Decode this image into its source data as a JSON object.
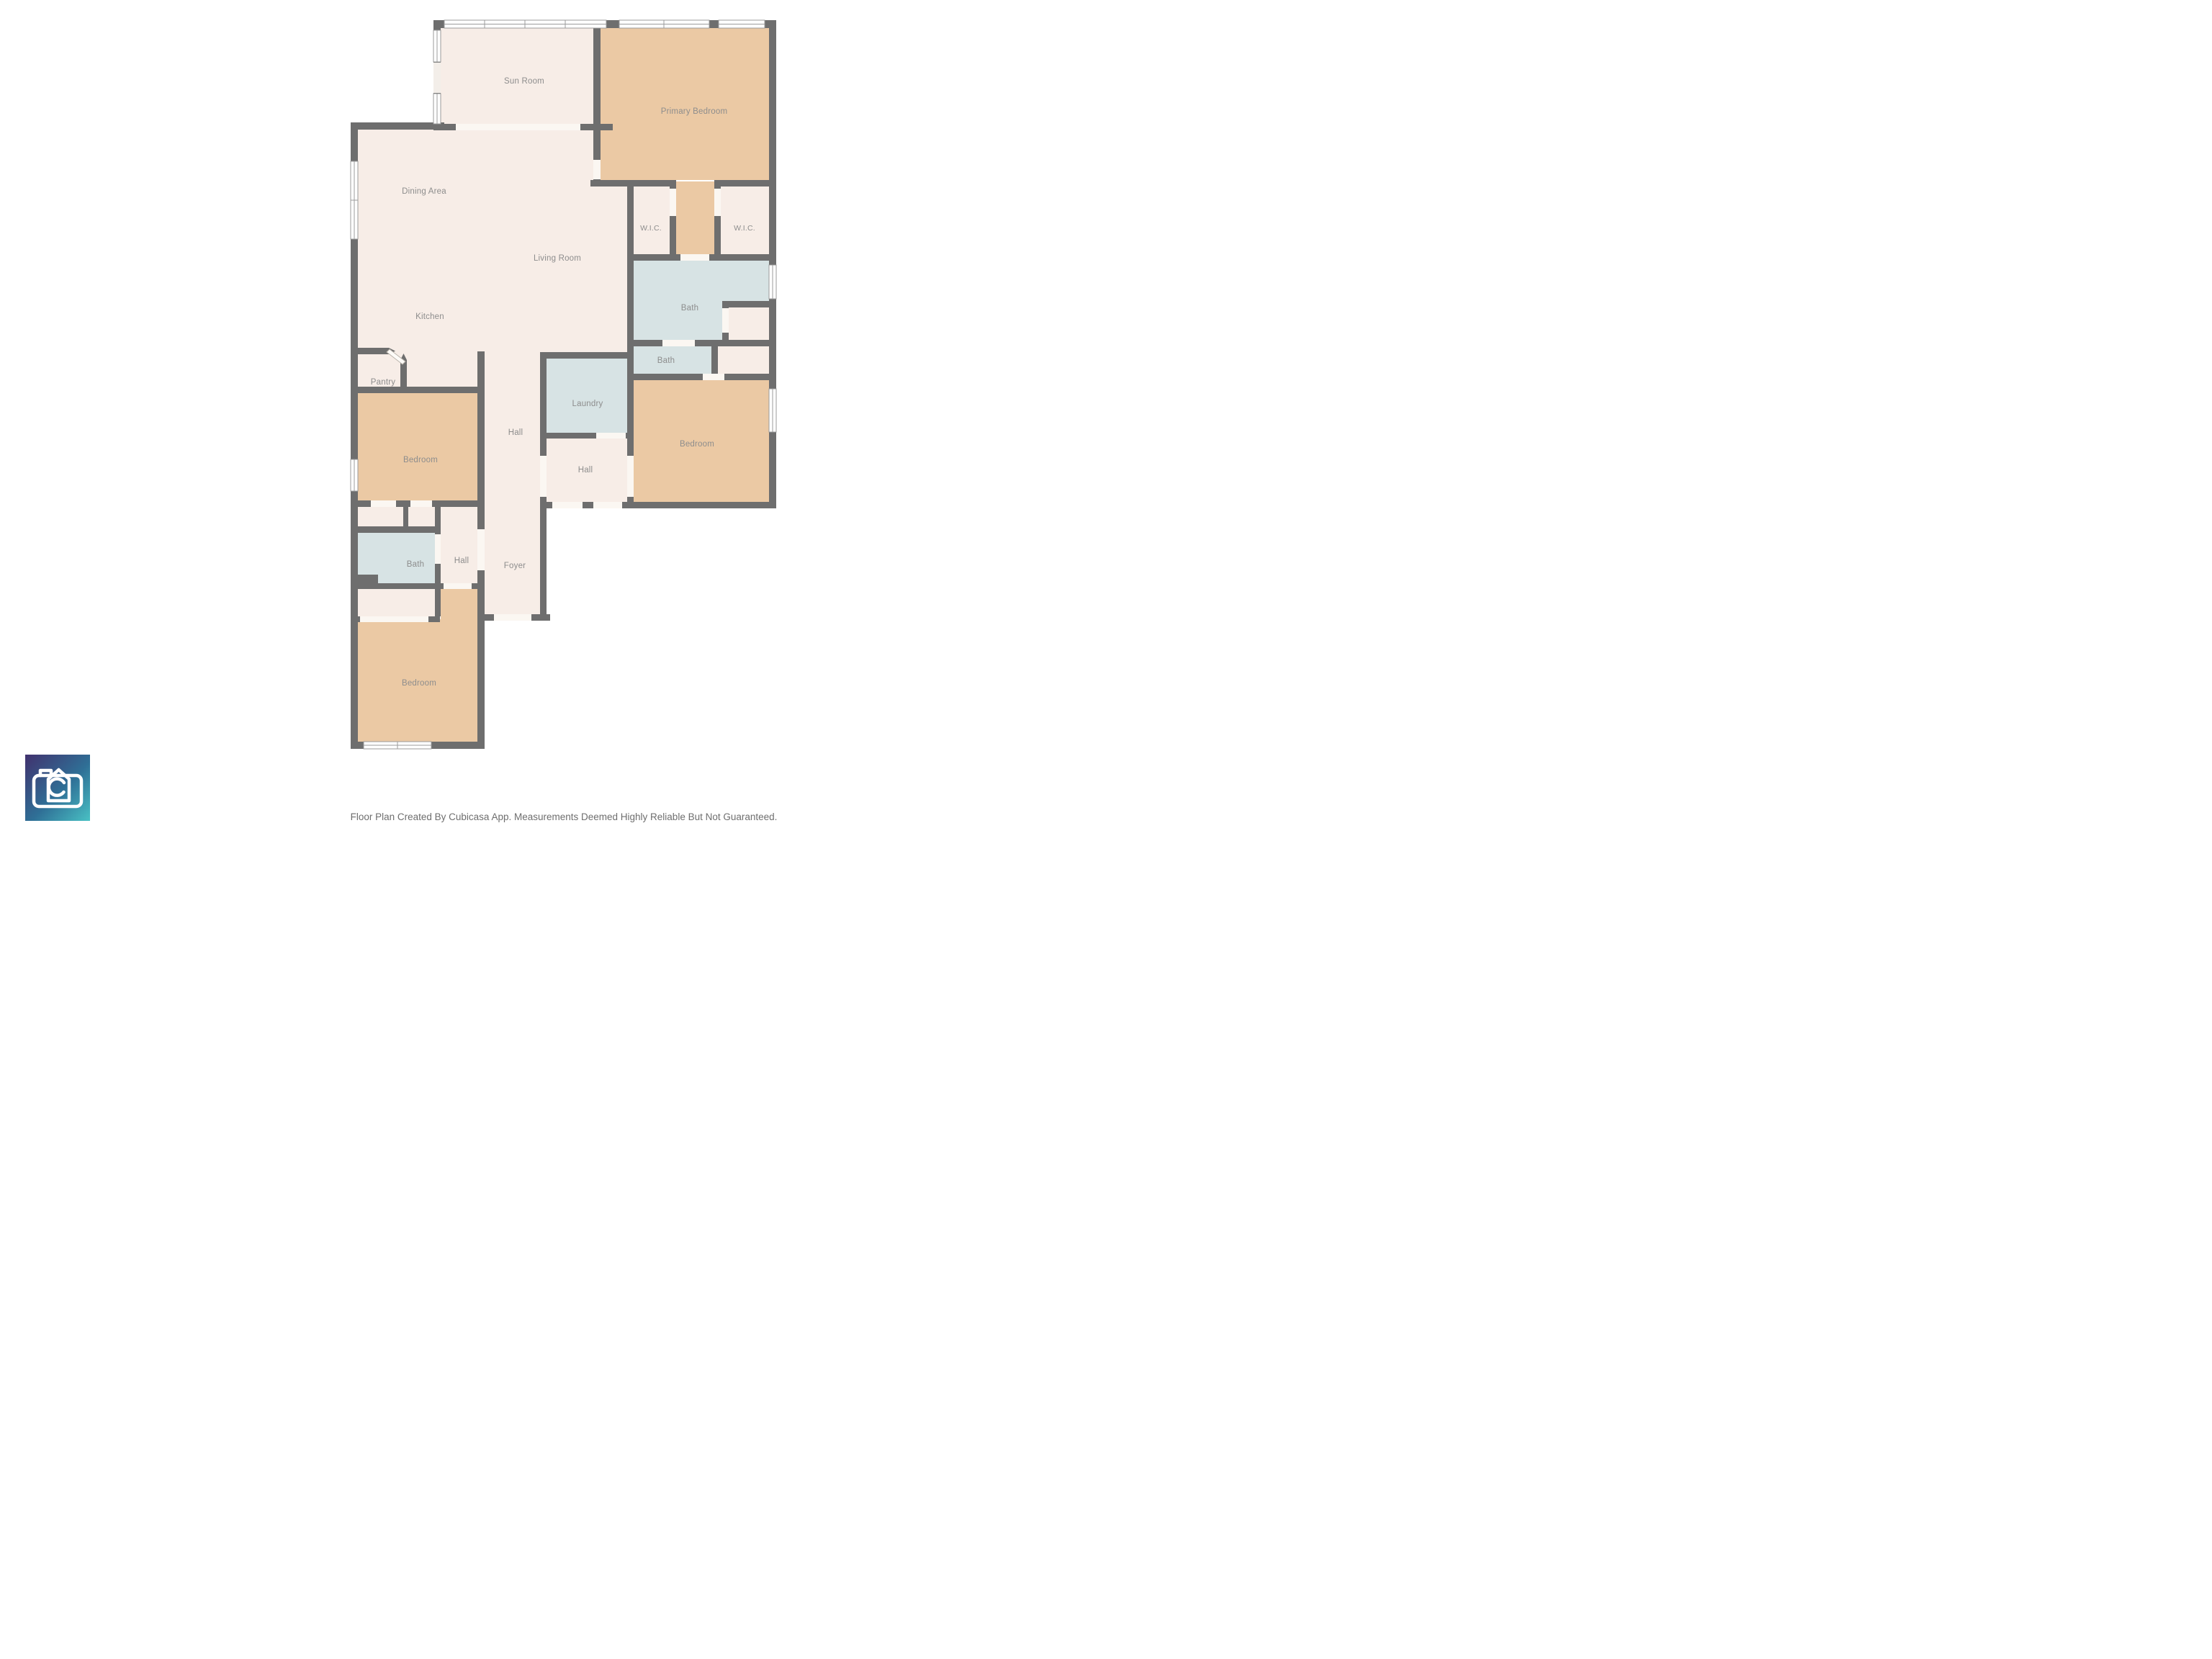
{
  "page": {
    "background": "#ffffff"
  },
  "colors": {
    "wall": "#6e6e6e",
    "cream": "#f7ede7",
    "tan": "#ebc9a4",
    "blue": "#d7e3e4",
    "opening": "#fbf7f2",
    "window_line": "#9b9b9b",
    "label": "#8d8d8d",
    "footer_text": "#6e6e6e",
    "logo_start": "#41316e",
    "logo_mid": "#2f6f96",
    "logo_end": "#49c1c4"
  },
  "rooms": [
    {
      "id": "sun-room",
      "label": "Sun Room"
    },
    {
      "id": "primary-bedroom",
      "label": "Primary Bedroom"
    },
    {
      "id": "wic-left",
      "label": "W.I.C."
    },
    {
      "id": "wic-right",
      "label": "W.I.C."
    },
    {
      "id": "bath-primary",
      "label": "Bath"
    },
    {
      "id": "bath-hall",
      "label": "Bath"
    },
    {
      "id": "bedroom-right",
      "label": "Bedroom"
    },
    {
      "id": "laundry",
      "label": "Laundry"
    },
    {
      "id": "hall-right",
      "label": "Hall"
    },
    {
      "id": "dining-area",
      "label": "Dining Area"
    },
    {
      "id": "living-room",
      "label": "Living Room"
    },
    {
      "id": "kitchen",
      "label": "Kitchen"
    },
    {
      "id": "pantry",
      "label": "Pantry"
    },
    {
      "id": "hall-center",
      "label": "Hall"
    },
    {
      "id": "bedroom-left",
      "label": "Bedroom"
    },
    {
      "id": "bath-left",
      "label": "Bath"
    },
    {
      "id": "hall-small",
      "label": "Hall"
    },
    {
      "id": "foyer",
      "label": "Foyer"
    },
    {
      "id": "bedroom-bottom",
      "label": "Bedroom"
    }
  ],
  "logo": {
    "name": "Cubicasa",
    "icon": "camera-house-icon"
  },
  "footer": {
    "disclaimer": "Floor Plan Created By Cubicasa App. Measurements Deemed Highly Reliable But Not Guaranteed."
  }
}
